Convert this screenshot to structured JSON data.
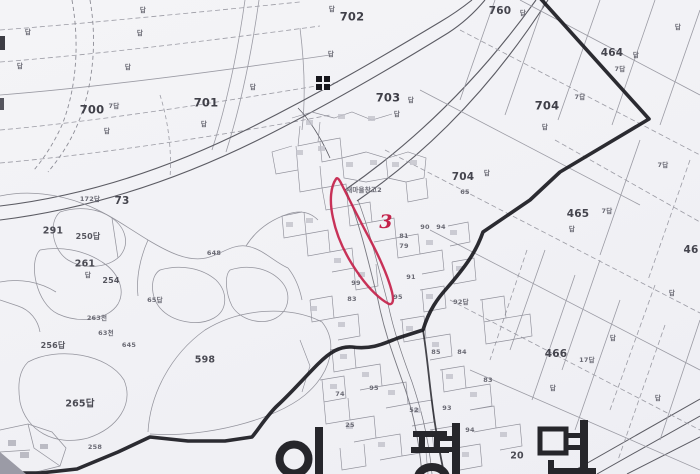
{
  "map": {
    "kind": "cadastral-map-scan",
    "region_name": "이평면",
    "region_name_chars": [
      "이",
      "평",
      "면"
    ],
    "highlight": {
      "parcel_label": "3",
      "color": "#c4224a"
    },
    "colors": {
      "background": "#f3f3f6",
      "parcel_line": "#9b9ba4",
      "road_edge": "#5c5c64",
      "admin_boundary": "#1a1a20",
      "label_text": "#45454e",
      "highlight": "#c4224a"
    },
    "symbols": [
      {
        "name": "control-point-marker",
        "x": 322,
        "y": 82
      }
    ],
    "labels": [
      {
        "t": "702",
        "x": 352,
        "y": 17,
        "s": "xl"
      },
      {
        "t": "760",
        "x": 500,
        "y": 11,
        "s": "lg"
      },
      {
        "t": "답",
        "x": 523,
        "y": 13,
        "s": "xs"
      },
      {
        "t": "464",
        "x": 612,
        "y": 53,
        "s": "lg"
      },
      {
        "t": "답",
        "x": 636,
        "y": 55,
        "s": "xs"
      },
      {
        "t": "7답",
        "x": 620,
        "y": 69,
        "s": "xs"
      },
      {
        "t": "703",
        "x": 388,
        "y": 98,
        "s": "xl"
      },
      {
        "t": "답",
        "x": 411,
        "y": 100,
        "s": "xs"
      },
      {
        "t": "답",
        "x": 397,
        "y": 114,
        "s": "xs"
      },
      {
        "t": "704",
        "x": 547,
        "y": 106,
        "s": "xl"
      },
      {
        "t": "7답",
        "x": 580,
        "y": 97,
        "s": "xs"
      },
      {
        "t": "답",
        "x": 545,
        "y": 127,
        "s": "xs"
      },
      {
        "t": "704",
        "x": 463,
        "y": 177,
        "s": "lg"
      },
      {
        "t": "답",
        "x": 487,
        "y": 173,
        "s": "xs"
      },
      {
        "t": "65",
        "x": 465,
        "y": 192,
        "s": "xs"
      },
      {
        "t": "465",
        "x": 578,
        "y": 214,
        "s": "lg"
      },
      {
        "t": "7답",
        "x": 607,
        "y": 211,
        "s": "xs"
      },
      {
        "t": "답",
        "x": 572,
        "y": 229,
        "s": "xs"
      },
      {
        "t": "46",
        "x": 691,
        "y": 250,
        "s": "lg"
      },
      {
        "t": "466",
        "x": 556,
        "y": 354,
        "s": "lg"
      },
      {
        "t": "17답",
        "x": 587,
        "y": 360,
        "s": "xs"
      },
      {
        "t": "답",
        "x": 613,
        "y": 338,
        "s": "xs"
      },
      {
        "t": "700",
        "x": 92,
        "y": 110,
        "s": "xl"
      },
      {
        "t": "7답",
        "x": 114,
        "y": 106,
        "s": "xs"
      },
      {
        "t": "답",
        "x": 107,
        "y": 131,
        "s": "xs"
      },
      {
        "t": "701",
        "x": 206,
        "y": 103,
        "s": "xl"
      },
      {
        "t": "답",
        "x": 204,
        "y": 124,
        "s": "xs"
      },
      {
        "t": "73",
        "x": 122,
        "y": 201,
        "s": "lg"
      },
      {
        "t": "172답",
        "x": 90,
        "y": 199,
        "s": "xs"
      },
      {
        "t": "598",
        "x": 205,
        "y": 360,
        "s": "md"
      },
      {
        "t": "265답",
        "x": 80,
        "y": 404,
        "s": "md"
      },
      {
        "t": "291",
        "x": 53,
        "y": 231,
        "s": "md"
      },
      {
        "t": "250답",
        "x": 88,
        "y": 237,
        "s": "sm"
      },
      {
        "t": "261",
        "x": 85,
        "y": 264,
        "s": "md"
      },
      {
        "t": "답",
        "x": 88,
        "y": 275,
        "s": "xs"
      },
      {
        "t": "254",
        "x": 111,
        "y": 281,
        "s": "sm"
      },
      {
        "t": "256답",
        "x": 53,
        "y": 346,
        "s": "sm"
      },
      {
        "t": "645",
        "x": 129,
        "y": 345,
        "s": "xs"
      },
      {
        "t": "63천",
        "x": 106,
        "y": 333,
        "s": "xs"
      },
      {
        "t": "263천",
        "x": 97,
        "y": 318,
        "s": "xs"
      },
      {
        "t": "648",
        "x": 214,
        "y": 253,
        "s": "xs"
      },
      {
        "t": "65답",
        "x": 155,
        "y": 300,
        "s": "xs"
      },
      {
        "t": "새마을창고2",
        "x": 364,
        "y": 190,
        "s": "xs"
      },
      {
        "t": "20",
        "x": 517,
        "y": 456,
        "s": "md"
      },
      {
        "t": "81",
        "x": 404,
        "y": 236,
        "s": "xs"
      },
      {
        "t": "79",
        "x": 404,
        "y": 246,
        "s": "xs"
      },
      {
        "t": "94",
        "x": 441,
        "y": 227,
        "s": "xs"
      },
      {
        "t": "90",
        "x": 425,
        "y": 227,
        "s": "xs"
      },
      {
        "t": "91",
        "x": 411,
        "y": 277,
        "s": "xs"
      },
      {
        "t": "95",
        "x": 398,
        "y": 297,
        "s": "xs"
      },
      {
        "t": "92답",
        "x": 461,
        "y": 302,
        "s": "xs"
      },
      {
        "t": "85",
        "x": 436,
        "y": 352,
        "s": "xs"
      },
      {
        "t": "84",
        "x": 462,
        "y": 352,
        "s": "xs"
      },
      {
        "t": "83",
        "x": 488,
        "y": 380,
        "s": "xs"
      },
      {
        "t": "93",
        "x": 447,
        "y": 408,
        "s": "xs"
      },
      {
        "t": "99",
        "x": 356,
        "y": 283,
        "s": "xs"
      },
      {
        "t": "83",
        "x": 352,
        "y": 299,
        "s": "xs"
      },
      {
        "t": "74",
        "x": 340,
        "y": 394,
        "s": "xs"
      },
      {
        "t": "95",
        "x": 374,
        "y": 388,
        "s": "xs"
      },
      {
        "t": "52",
        "x": 414,
        "y": 410,
        "s": "xs"
      },
      {
        "t": "94",
        "x": 470,
        "y": 430,
        "s": "xs"
      },
      {
        "t": "25",
        "x": 350,
        "y": 425,
        "s": "xs"
      },
      {
        "t": "258",
        "x": 95,
        "y": 447,
        "s": "xs"
      },
      {
        "t": "답",
        "x": 28,
        "y": 32,
        "s": "xs"
      },
      {
        "t": "답",
        "x": 143,
        "y": 10,
        "s": "xs"
      },
      {
        "t": "답",
        "x": 140,
        "y": 33,
        "s": "xs"
      },
      {
        "t": "답",
        "x": 20,
        "y": 66,
        "s": "xs"
      },
      {
        "t": "답",
        "x": 128,
        "y": 67,
        "s": "xs"
      },
      {
        "t": "답",
        "x": 253,
        "y": 87,
        "s": "xs"
      },
      {
        "t": "답",
        "x": 332,
        "y": 9,
        "s": "xs"
      },
      {
        "t": "답",
        "x": 331,
        "y": 54,
        "s": "xs"
      },
      {
        "t": "답",
        "x": 678,
        "y": 27,
        "s": "xs"
      },
      {
        "t": "7답",
        "x": 663,
        "y": 165,
        "s": "xs"
      },
      {
        "t": "답",
        "x": 672,
        "y": 293,
        "s": "xs"
      },
      {
        "t": "답",
        "x": 658,
        "y": 398,
        "s": "xs"
      },
      {
        "t": "답",
        "x": 553,
        "y": 388,
        "s": "xs"
      }
    ]
  }
}
